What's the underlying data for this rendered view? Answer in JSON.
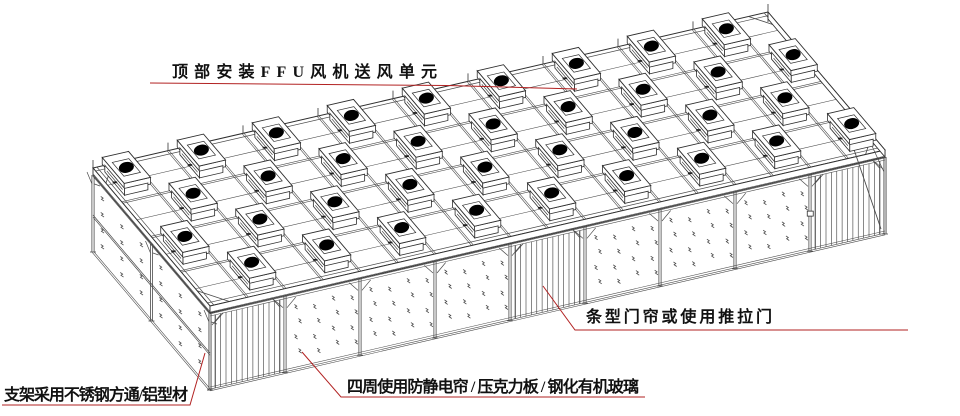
{
  "diagram": {
    "type": "isometric-technical-drawing",
    "subject": "clean-booth / cleanroom frame with FFU units",
    "background": "#ffffff",
    "line_color": "#4a4a4a",
    "dark_line_color": "#2e2e2e",
    "annotation_color": "#b22222",
    "text_color": "#111111",
    "fan_color": "#000000",
    "annotations": {
      "ffu": {
        "text": "顶部安装FFU风机送风单元"
      },
      "frame": {
        "text": "支架采用不锈钢方通/铝型材"
      },
      "enclosure": {
        "text": "四周使用防静电帘 / 压克力板 / 钢化有机玻璃"
      },
      "door": {
        "text": "条型门帘或使用推拉门"
      }
    },
    "structure": {
      "ffu_rows": 4,
      "ffu_per_row": 9,
      "ffu_total": 36,
      "roof_grid_cols": 18,
      "roof_grid_rows": 4,
      "front_wall_bays": 9,
      "door_bay_indices": [
        0,
        4,
        8
      ],
      "left_wall_bays": 2,
      "wall_panel_marks": "sparkle",
      "door_style": "vertical-strip-curtain"
    }
  }
}
